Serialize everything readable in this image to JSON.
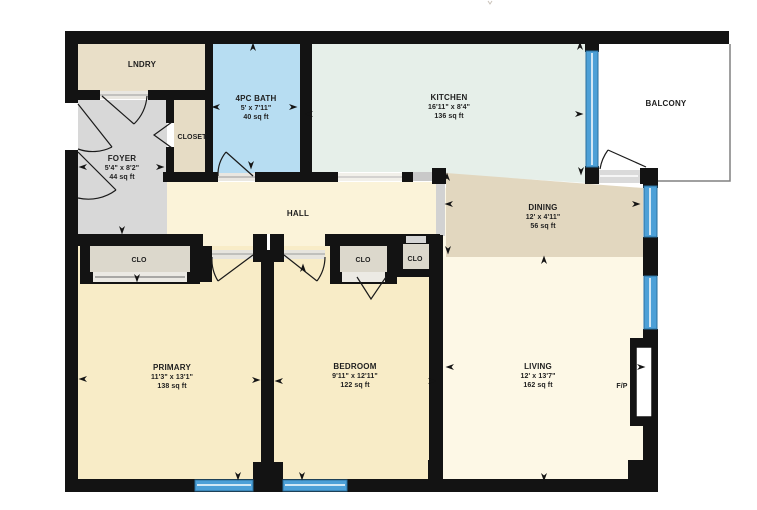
{
  "plan": {
    "type": "residential-floor-plan"
  },
  "colors": {
    "wall": "#131313",
    "window": "#4da0d7",
    "window_edge": "#2a6f9e",
    "lndry": "#e9dfc8",
    "closet_room": "#e6dcc5",
    "dining": "#e2d7bf",
    "foyer": "#d8d8d8",
    "bath": "#b7ddf2",
    "kitchen": "#e6efe9",
    "hall": "#fbf3d9",
    "bedroom_fill": "#f8ecc7",
    "primary_fill": "#f8ecc7",
    "living": "#fdf8e6",
    "clo_fill": "#dcd8cc",
    "threshold": "#e9e7e1",
    "half_wall": "#d2d2d2",
    "balcony": "#ffffff"
  },
  "rooms": {
    "lndry": {
      "name": "LNDRY"
    },
    "bath": {
      "name": "4PC BATH",
      "dims": "5' x 7'11\"",
      "area": "40 sq ft"
    },
    "kitchen": {
      "name": "KITCHEN",
      "dims": "16'11\" x 8'4\"",
      "area": "136 sq ft"
    },
    "balcony": {
      "name": "BALCONY"
    },
    "closet": {
      "name": "CLOSET"
    },
    "foyer": {
      "name": "FOYER",
      "dims": "5'4\" x 8'2\"",
      "area": "44 sq ft"
    },
    "hall": {
      "name": "HALL"
    },
    "dining": {
      "name": "DINING",
      "dims": "12' x 4'11\"",
      "area": "56 sq ft"
    },
    "primary": {
      "name": "PRIMARY",
      "dims": "11'3\" x 13'1\"",
      "area": "138 sq ft"
    },
    "bedroom": {
      "name": "BEDROOM",
      "dims": "9'11\" x 12'11\"",
      "area": "122 sq ft"
    },
    "living": {
      "name": "LIVING",
      "dims": "12' x 13'7\"",
      "area": "162 sq ft"
    },
    "clo_primary": {
      "name": "CLO"
    },
    "clo_bedroom_left": {
      "name": "CLO"
    },
    "clo_bedroom_right": {
      "name": "CLO"
    },
    "fireplace": {
      "name": "F/P"
    }
  },
  "arrows": [
    {
      "x": 253,
      "y": 47,
      "d": "up"
    },
    {
      "x": 216,
      "y": 107,
      "d": "left"
    },
    {
      "x": 293,
      "y": 107,
      "d": "right"
    },
    {
      "x": 251,
      "y": 165,
      "d": "down"
    },
    {
      "x": 309,
      "y": 114,
      "d": "left"
    },
    {
      "x": 579,
      "y": 114,
      "d": "right"
    },
    {
      "x": 580,
      "y": 46,
      "d": "up"
    },
    {
      "x": 581,
      "y": 171,
      "d": "down"
    },
    {
      "x": 447,
      "y": 177,
      "d": "up"
    },
    {
      "x": 83,
      "y": 167,
      "d": "left"
    },
    {
      "x": 160,
      "y": 167,
      "d": "right"
    },
    {
      "x": 122,
      "y": 230,
      "d": "down"
    },
    {
      "x": 449,
      "y": 204,
      "d": "left"
    },
    {
      "x": 636,
      "y": 204,
      "d": "right"
    },
    {
      "x": 448,
      "y": 250,
      "d": "down"
    },
    {
      "x": 544,
      "y": 260,
      "d": "up"
    },
    {
      "x": 83,
      "y": 379,
      "d": "left"
    },
    {
      "x": 256,
      "y": 380,
      "d": "right"
    },
    {
      "x": 279,
      "y": 381,
      "d": "left"
    },
    {
      "x": 432,
      "y": 381,
      "d": "right"
    },
    {
      "x": 238,
      "y": 476,
      "d": "down"
    },
    {
      "x": 302,
      "y": 476,
      "d": "down"
    },
    {
      "x": 450,
      "y": 367,
      "d": "left"
    },
    {
      "x": 641,
      "y": 367,
      "d": "right"
    },
    {
      "x": 544,
      "y": 477,
      "d": "down"
    },
    {
      "x": 137,
      "y": 278,
      "d": "down"
    },
    {
      "x": 303,
      "y": 268,
      "d": "up"
    }
  ]
}
